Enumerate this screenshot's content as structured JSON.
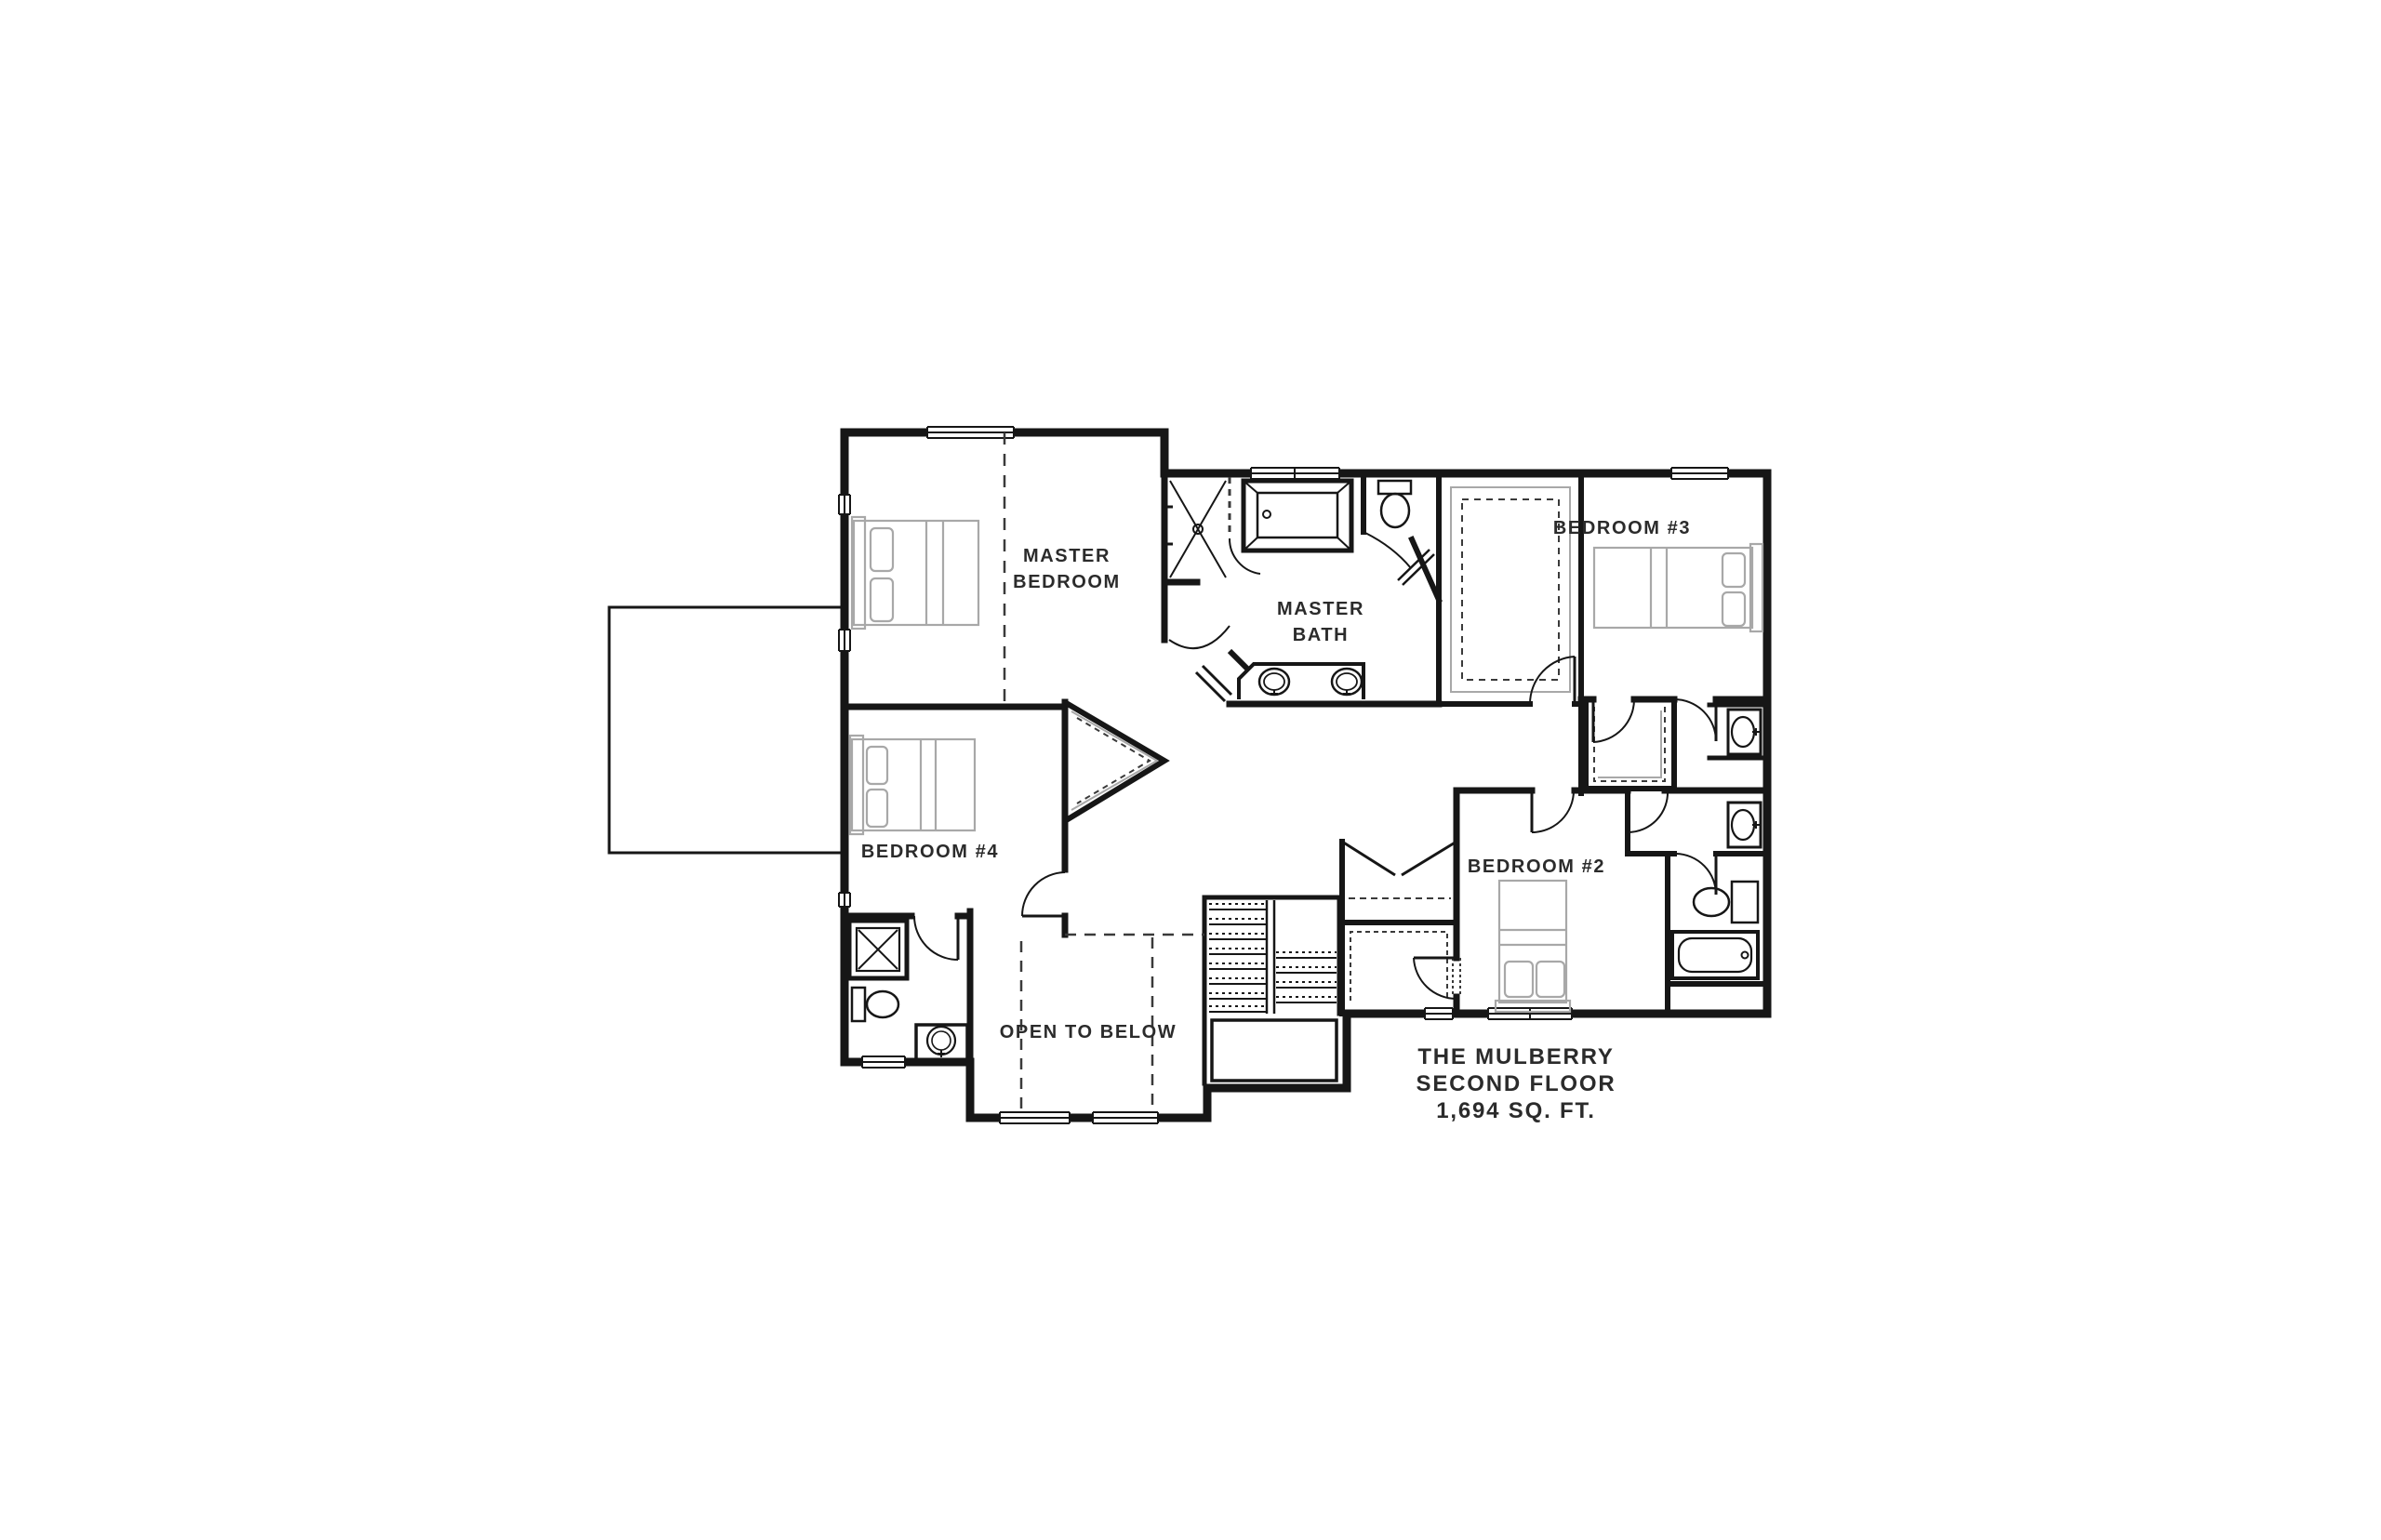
{
  "plan": {
    "title": {
      "line1": "THE MULBERRY",
      "line2": "SECOND FLOOR",
      "line3": "1,694 SQ. FT."
    },
    "rooms": {
      "master_bedroom": {
        "label": "MASTER BEDROOM",
        "lines": [
          "MASTER",
          "BEDROOM"
        ]
      },
      "master_bath": {
        "label": "MASTER BATH",
        "lines": [
          "MASTER",
          "BATH"
        ]
      },
      "bedroom_3": {
        "label": "BEDROOM #3",
        "lines": [
          "BEDROOM #3"
        ]
      },
      "bedroom_4": {
        "label": "BEDROOM #4",
        "lines": [
          "BEDROOM #4"
        ]
      },
      "bedroom_2": {
        "label": "BEDROOM #2",
        "lines": [
          "BEDROOM #2"
        ]
      },
      "open_to_below": {
        "label": "OPEN TO BELOW",
        "lines": [
          "OPEN TO BELOW"
        ]
      }
    },
    "colors": {
      "wall": "#161616",
      "furniture": "#a8a8a8",
      "dash": "#3a3a3a",
      "text": "#2b2b2b",
      "background": "#ffffff"
    }
  }
}
